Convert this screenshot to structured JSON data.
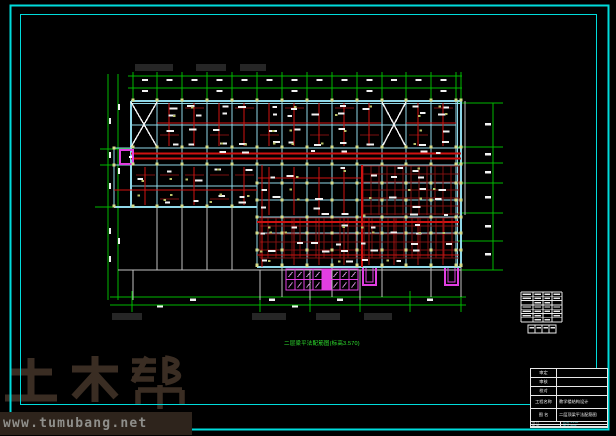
{
  "watermark": {
    "brand": "土木帮",
    "site": "www.tumubang.net"
  },
  "drawing": {
    "title": "二层梁平法配筋图(标高3.570)",
    "colors": {
      "frame_cyan": "#00dcdc",
      "axis_green": "#00b800",
      "beam_red": "#cf1211",
      "beam_dark_red": "#7d1010",
      "slab_cyan": "#8fd8e8",
      "stair_magenta": "#e23ee2",
      "column_olive": "#d6dc8a"
    }
  },
  "title_block": {
    "rows": [
      {
        "label": "审定",
        "value": ""
      },
      {
        "label": "审核",
        "value": ""
      },
      {
        "label": "校对",
        "value": ""
      },
      {
        "label": "工程名称",
        "value": "教学楼结构设计"
      },
      {
        "label": "图 名",
        "value": "二层顶梁平法配筋图"
      }
    ],
    "footer_rows": [
      {
        "c1": "设 计",
        "c2": "比例 1:100"
      },
      {
        "c1": "制 图",
        "c2": "图号 结施"
      }
    ]
  }
}
